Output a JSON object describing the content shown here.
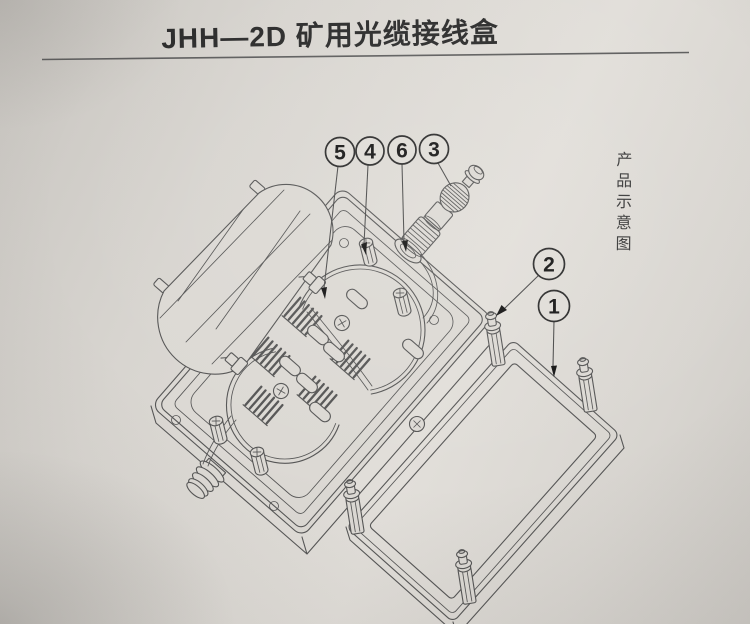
{
  "page": {
    "title": "JHH—2D 矿用光缆接线盒",
    "side_caption": "产品示意图"
  },
  "callouts": [
    {
      "label": "5"
    },
    {
      "label": "4"
    },
    {
      "label": "6"
    },
    {
      "label": "3"
    },
    {
      "label": "2"
    },
    {
      "label": "1"
    }
  ],
  "colors": {
    "paper": "#dcd9d4",
    "line": "#565656",
    "ink": "#161616"
  },
  "diagram": {
    "numbered_callouts_visible": [
      "5",
      "4",
      "6",
      "3",
      "2",
      "1"
    ]
  }
}
